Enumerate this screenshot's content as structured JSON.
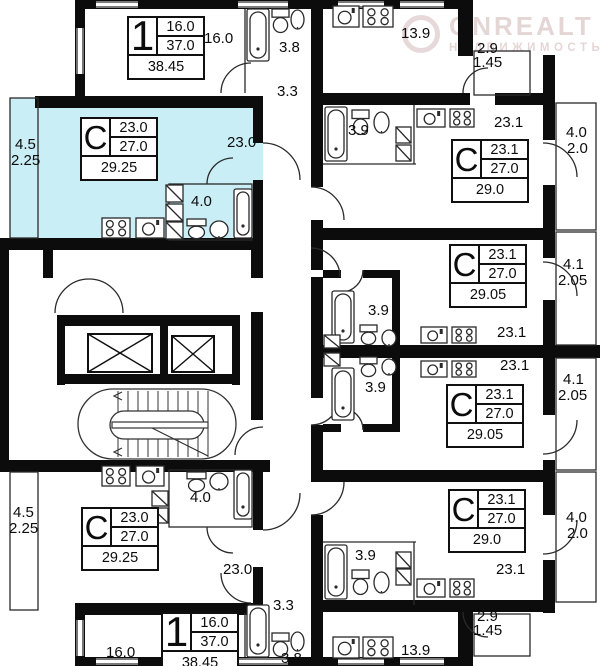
{
  "watermark": {
    "brand": "ONREALT",
    "subtitle": "НЕДВИЖИМОСТЬ"
  },
  "colors": {
    "highlight": "#c9eef6",
    "wall": "#0c0c0c"
  },
  "cards": {
    "apt1_top": {
      "letter": "1",
      "row1": "16.0",
      "row2": "37.0",
      "row3": "38.45"
    },
    "studio_tl": {
      "letter": "С",
      "row1": "23.0",
      "row2": "27.0",
      "row3": "29.25"
    },
    "studio_r1": {
      "letter": "С",
      "row1": "23.1",
      "row2": "27.0",
      "row3": "29.0"
    },
    "studio_r2": {
      "letter": "С",
      "row1": "23.1",
      "row2": "27.0",
      "row3": "29.05"
    },
    "studio_r3": {
      "letter": "С",
      "row1": "23.1",
      "row2": "27.0",
      "row3": "29.05"
    },
    "studio_r4": {
      "letter": "С",
      "row1": "23.1",
      "row2": "27.0",
      "row3": "29.0"
    },
    "studio_bl": {
      "letter": "С",
      "row1": "23.0",
      "row2": "27.0",
      "row3": "29.25"
    },
    "apt1_bottom": {
      "letter": "1",
      "row1": "16.0",
      "row2": "37.0",
      "row3": "38.45"
    }
  },
  "labels": {
    "apt1_top_room": "16.0",
    "bath_top": "3.8",
    "hall_top": "3.3",
    "kitchen_top": "13.9",
    "loggia_top_1": "2.9",
    "loggia_top_2": "1.45",
    "balcony_tl_1": "4.5",
    "balcony_tl_2": "2.25",
    "studio_tl_room": "23.0",
    "studio_tl_bath": "4.0",
    "r1_bath": "3.9",
    "r1_room": "23.1",
    "r1_balc_1": "4.0",
    "r1_balc_2": "2.0",
    "r2_room": "23.1",
    "r2_balc_1": "4.1",
    "r2_balc_2": "2.05",
    "mid_bath_top": "3.9",
    "mid_bath_bot": "3.9",
    "r3_room": "23.1",
    "r3_balc_1": "4.1",
    "r3_balc_2": "2.05",
    "r4_room": "23.1",
    "r4_bath": "3.9",
    "r4_balc_1": "4.0",
    "r4_balc_2": "2.0",
    "loggia_bot_1": "2.9",
    "loggia_bot_2": "1.45",
    "kitchen_bot": "13.9",
    "balcony_bl_1": "4.5",
    "balcony_bl_2": "2.25",
    "studio_bl_room": "23.0",
    "studio_bl_bath": "4.0",
    "apt1_bot_room": "16.0",
    "hall_bot": "3.3",
    "bath_bot": "3.8"
  }
}
